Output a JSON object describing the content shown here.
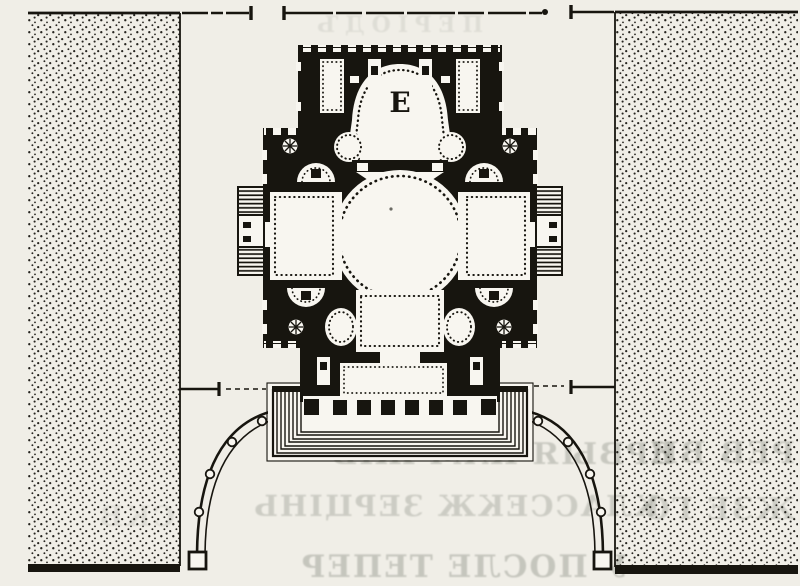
{
  "document": {
    "kind": "scanned book figure",
    "subject": "floor plan of a domed cross-plan church with stepped west front and semicircular colonnaded atrium, flanked by stippled garden plots",
    "altar_mark": "E"
  },
  "colors": {
    "paper": "#f0eee7",
    "ink": "#17150f",
    "interior_white": "#f8f6f0",
    "bleedthrough": "#6e7368"
  },
  "bleedthrough_faint_text": {
    "top": "ПЕРІОДЪ",
    "line1": "ЕРВЫЯ КАМ ЖІВ",
    "line2": "КЛАССЕКЖ ЗЕРЦІНЬ",
    "line3": "У ПОСЛЕ ТЕПЕР",
    "right1": "РЕВ ВИ",
    "right2": "ЖЗЕ ГО",
    "left1": "СКВ"
  }
}
